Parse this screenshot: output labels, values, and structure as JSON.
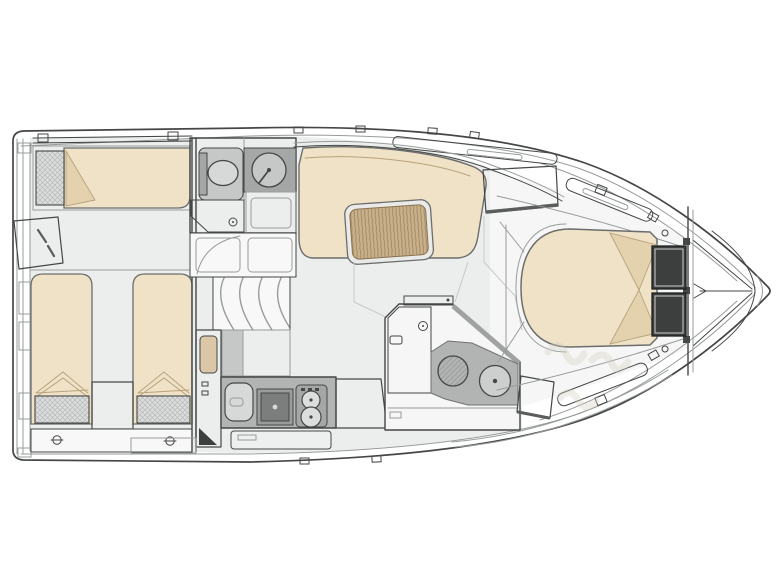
{
  "meta": {
    "description": "Motor yacht lower-deck floor plan, line drawing, bow pointing right",
    "canvas_width": 779,
    "canvas_height": 584
  },
  "colors": {
    "line": "#444745",
    "lineSoft": "#979c9a",
    "lineFaint": "#c6c9c8",
    "floor": "#eceeed",
    "floorLight": "#f5f6f5",
    "panel": "#f7f8f7",
    "bed": "#f0e2c7",
    "bedEdge": "#6b6e6c",
    "bedShade": "#e4d2af",
    "foldLine": "#b7a27d",
    "woodBase": "#d8c2a3",
    "woodLine": "#b3966f",
    "woodFineBase": "#dcc6a8",
    "woodFineLine": "#bb9e78",
    "grainBase": "#c8b18c",
    "grainLine": "#a1875e",
    "fixGray": "#c6c8c7",
    "fixGrayLight": "#d7d9d8",
    "fixGrayDark": "#a4a7a6",
    "counter": "#b2b4b3",
    "stoveDark": "#7b7e7d",
    "pillowBase": "#dcdedd",
    "pillowLine": "#b6b9b8",
    "darkPillow": "#3c3f3e",
    "shadow": "#5a5d5c",
    "wmColor": "#d8cec2"
  },
  "plan": {
    "vessel_view": "lower deck, top view",
    "rooms": [
      {
        "name": "aft cabin",
        "fixtures": [
          "athwartships single berth with pillow",
          "twin parallel berths with pillows",
          "angled wardrobe",
          "center step between berths"
        ]
      },
      {
        "name": "head with shower",
        "fixtures": [
          "toilet",
          "round washbasin on vanity",
          "teak shower grating"
        ]
      },
      {
        "name": "companionway",
        "fixtures": [
          "curved steps",
          "door swing arc"
        ]
      },
      {
        "name": "salon dinette",
        "fixtures": [
          "c-shaped sofa",
          "teak table",
          "hatched sideboard"
        ]
      },
      {
        "name": "galley",
        "fixtures": [
          "tall cabinet",
          "sink",
          "cooktop",
          "two-burner unit",
          "teak worktop",
          "drawers"
        ]
      },
      {
        "name": "day head",
        "fixtures": [
          "teak shower grating",
          "round hatched washbasin",
          "toilet",
          "teak step outside"
        ]
      },
      {
        "name": "forward cabin",
        "fixtures": [
          "island berth with rounded foot",
          "two dark pillows",
          "collision bulkhead",
          "bow v-frames"
        ]
      }
    ]
  },
  "watermark": {
    "visible": true,
    "legible": false
  }
}
